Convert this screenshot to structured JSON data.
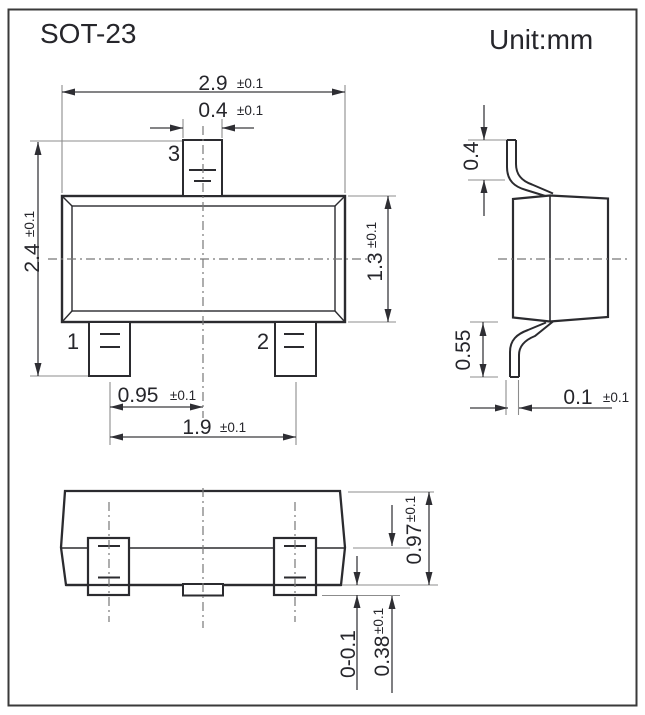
{
  "page": {
    "title": "SOT-23",
    "unit_label": "Unit:mm"
  },
  "top_view": {
    "pin_labels": {
      "pin1": "1",
      "pin2": "2",
      "pin3": "3"
    },
    "dims": {
      "body_width": {
        "value": "2.9",
        "tol": "±0.1"
      },
      "pin3_width": {
        "value": "0.4",
        "tol": "±0.1"
      },
      "overall_length": {
        "value": "2.4",
        "tol": "±0.1"
      },
      "body_length": {
        "value": "1.3",
        "tol": "±0.1"
      },
      "pin_pitch": {
        "value": "0.95",
        "tol": "±0.1"
      },
      "pin_span": {
        "value": "1.9",
        "tol": "±0.1"
      }
    }
  },
  "side_view": {
    "dims": {
      "upper_lead_length": {
        "value": "0.4"
      },
      "lower_lead_length": {
        "value": "0.55"
      },
      "lead_thickness": {
        "value": "0.1",
        "tol": "±0.1"
      }
    }
  },
  "front_view": {
    "dims": {
      "body_height": {
        "value": "0.97",
        "tol": "±0.1"
      },
      "standoff": {
        "value": "0-0.1"
      },
      "lead_height": {
        "value": "0.38",
        "tol": "±0.1"
      }
    }
  }
}
